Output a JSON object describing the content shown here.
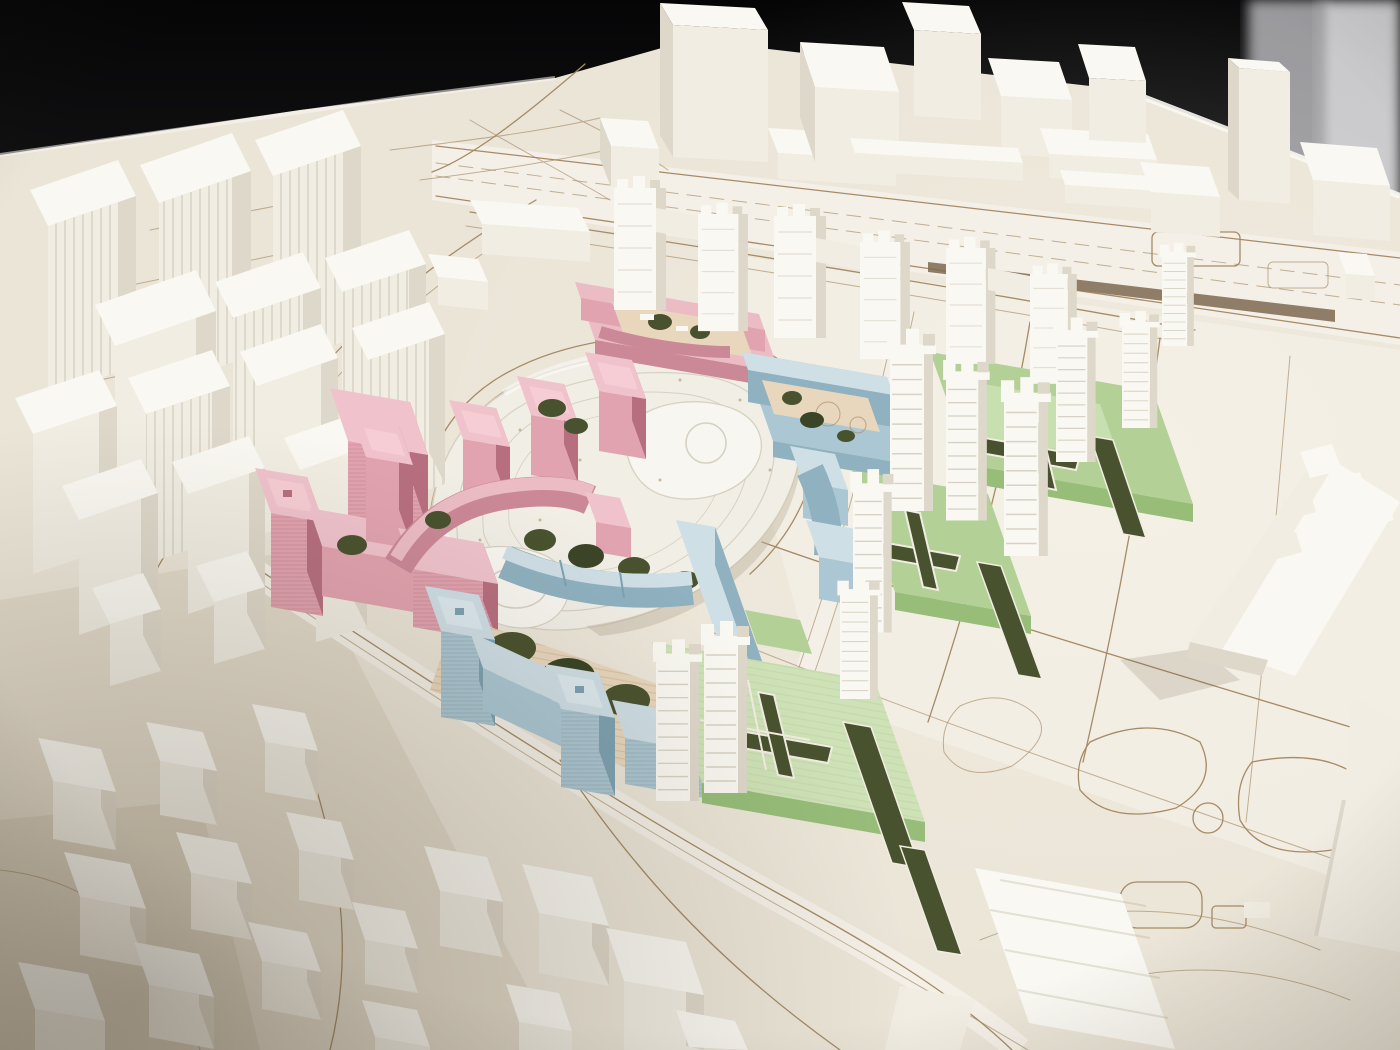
{
  "scene": {
    "type": "photograph",
    "subject": "Architectural massing model of an urban masterplan",
    "description": "High-angle photograph of a physical scale model: a central redevelopment site with pink, blue and green building clusters arranged around a white terraced park hill, surrounded by an all-white context city on a laser-etched baseboard, shot against a dark backdrop.",
    "visible_text": "none"
  },
  "palette": {
    "backdrop_top": "#050506",
    "backdrop_bottom": "#1a1a1c",
    "wall_gray_1": "#98989c",
    "wall_gray_2": "#c8c8cb",
    "base": "#ebe5d8",
    "base_light": "#f4f0e7",
    "base_shadow": "#d9d0bd",
    "base_deep": "#c9bfa9",
    "etch": "#a58b66",
    "road_dark": "#7c6950",
    "court": "#e8d7bd",
    "court_stripe": "#d8c6a6",
    "white_roof": "#faf8f2",
    "white_wall": "#f1ede3",
    "white_shade": "#ded8ca",
    "white_deep": "#cbc4b2",
    "pink_top": "#f0c3cc",
    "pink": "#e2a3b0",
    "pink_dark": "#cb8897",
    "pink_deep": "#b76f80",
    "pink_plinth": "#ecbcc5",
    "blue_top": "#cfdfe6",
    "blue": "#abc7d3",
    "blue_dark": "#8fb1c0",
    "blue_deep": "#7da2b1",
    "green_top": "#cde2b6",
    "green": "#b3d197",
    "green_dark": "#97bd79",
    "green_deep": "#83ab66",
    "foliage": "#49522e",
    "foliage_dark": "#3b4426",
    "hill": "#f1eee6",
    "hill_light": "#f8f6f0",
    "contour": "#d7d1c3",
    "hill_shadow": "#b9ad96"
  },
  "legend": {
    "districts": [
      {
        "name": "context-city",
        "color_key": "white_wall",
        "elements": "matte white massing blocks and slab towers"
      },
      {
        "name": "north-west-district",
        "color_key": "pink",
        "elements": "perimeter blocks, cube towers, curved slab, podium courtyard"
      },
      {
        "name": "south-district",
        "color_key": "blue",
        "elements": "courtyard block with corner towers, curved terrace rows"
      },
      {
        "name": "east-district",
        "color_key": "green",
        "elements": "green podiums with white ribbed high-rise towers and cross-shaped gardens"
      },
      {
        "name": "park-hill",
        "color_key": "hill",
        "elements": "terraced landscape mound with contour steps"
      },
      {
        "name": "planting",
        "color_key": "foliage",
        "elements": "flocked greenery patches and hedge strips"
      },
      {
        "name": "skybridge-towers",
        "color_key": "white_roof",
        "elements": "paired white towers linked by bridges along the north edge of the site"
      }
    ]
  }
}
